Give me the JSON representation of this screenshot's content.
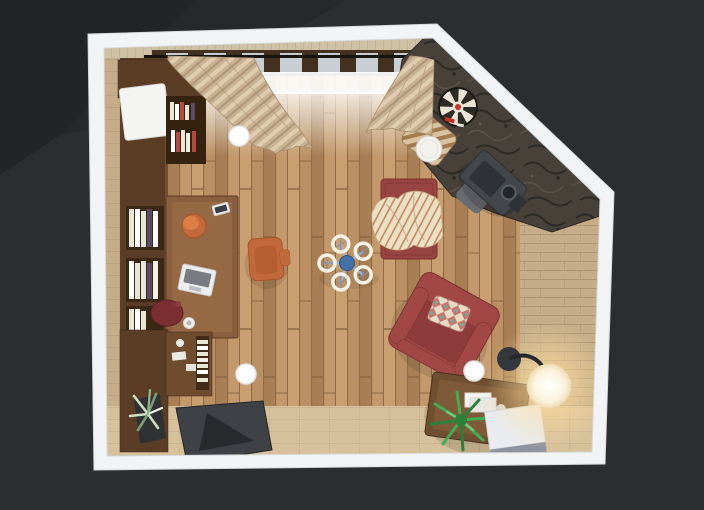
{
  "app": {
    "name": "3D Floor Plan — Top View Render",
    "view_label": "Top-down view of a living room with home-office corner"
  },
  "scene": {
    "room": {
      "label": "Living room floor plan, top view: pentagonal room with a cut corner, white walls, wood plank floor, stone accent wall along the diagonal",
      "wall_color_name": "white",
      "floor_material": "wood planks"
    },
    "objects": [
      {
        "id": "wall-cabinet",
        "label": "Dark wood wall cabinet with white door box",
        "zone": "top-left"
      },
      {
        "id": "wall-shelf-books",
        "label": "Open wall shelf with books",
        "zone": "top-left"
      },
      {
        "id": "bookshelf",
        "label": "Bookshelf with cream book spines",
        "zone": "left wall"
      },
      {
        "id": "office-desk",
        "label": "Dark wood office desk",
        "zone": "left"
      },
      {
        "id": "laptop",
        "label": "Laptop on desk",
        "zone": "left"
      },
      {
        "id": "tablet",
        "label": "Tablet on desk",
        "zone": "left"
      },
      {
        "id": "desk-cup",
        "label": "Orange desk organizer cup",
        "zone": "left"
      },
      {
        "id": "desk-lamp",
        "label": "Maroon table lamp with mug",
        "zone": "left"
      },
      {
        "id": "orange-armchair",
        "label": "Orange reading armchair",
        "zone": "center-left"
      },
      {
        "id": "ceiling-fan",
        "label": "5-blade ceiling fan with lights, blue hub",
        "zone": "center"
      },
      {
        "id": "ceiling-light",
        "label": "Round flush ceiling light (x3)",
        "zone": "various"
      },
      {
        "id": "window",
        "label": "Window band with dark mullions and curtain rod",
        "zone": "top wall"
      },
      {
        "id": "curtains",
        "label": "Beige wavy curtains, left and right",
        "zone": "top wall"
      },
      {
        "id": "stone-wall",
        "label": "Dark stone accent wall",
        "zone": "diagonal corner"
      },
      {
        "id": "dartboard",
        "label": "Dartboard on stone wall",
        "zone": "diagonal corner"
      },
      {
        "id": "wood-stove",
        "label": "Dark grey wood stove with pipe",
        "zone": "diagonal corner"
      },
      {
        "id": "floor-cushion",
        "label": "Grey floor cushion",
        "zone": "near stove"
      },
      {
        "id": "lounge-chair",
        "label": "Striped lounge chair",
        "zone": "upper right"
      },
      {
        "id": "round-side-table",
        "label": "White round side table",
        "zone": "upper right"
      },
      {
        "id": "red-daybed",
        "label": "Brick-red daybed sofa",
        "zone": "center-right"
      },
      {
        "id": "throw-blanket",
        "label": "Striped cream throw blanket",
        "zone": "on daybed"
      },
      {
        "id": "red-armchair",
        "label": "Brick-red armchair, rotated",
        "zone": "lower right"
      },
      {
        "id": "pillow",
        "label": "Patterned throw pillow",
        "zone": "on armchair"
      },
      {
        "id": "coffee-table",
        "label": "Dark wood coffee table with white books",
        "zone": "bottom right"
      },
      {
        "id": "palm-plant",
        "label": "Green palm plant",
        "zone": "bottom right"
      },
      {
        "id": "cube-table",
        "label": "White and grey cube side table",
        "zone": "bottom right"
      },
      {
        "id": "arc-floor-lamp",
        "label": "Glowing globe floor lamp with dark base",
        "zone": "bottom right corner"
      },
      {
        "id": "dark-rug",
        "label": "Dark angular rug",
        "zone": "bottom center-left"
      },
      {
        "id": "sideboard",
        "label": "Dark wood sideboard with dishes and books",
        "zone": "bottom left"
      },
      {
        "id": "potted-plant",
        "label": "Pale potted plant",
        "zone": "bottom left"
      }
    ]
  },
  "colors": {
    "bg": "#2b2d2f",
    "bg-dark": "#222426",
    "wall": "#f2f3f4",
    "wall-edge": "#d7d9db",
    "wall-face": "#cfc1a5",
    "floor-beige": "#c4ad88",
    "floor-beige-light": "#d7c19b",
    "plank": "#bb9164",
    "plank-light": "#c99f71",
    "plank-dark": "#a87f55",
    "plank-seam": "#8c6743",
    "wood-dark": "#5b3d26",
    "wood-mid": "#6f4c2e",
    "wood-light": "#8a6240",
    "desk": "#8a5f3d",
    "desk-light": "#9d7049",
    "stone": "#474139",
    "stone-dark": "#2e2a25",
    "stone-light": "#625a4d",
    "glass": "#c9ced3",
    "mullion": "#43311f",
    "rod": "#17130e",
    "curtain": "#c9b294",
    "curtain-light": "#e0cdb0",
    "curtain-dark": "#a98e6e",
    "red-sofa": "#974442",
    "red-chair": "#a14846",
    "red-dark": "#7c302f",
    "maroon": "#7c2f33",
    "throw": "#ecdfc4",
    "throw-stripe": "#c08a62",
    "pillow-base": "#e6dcc6",
    "pillow-red": "#c0625c",
    "pillow-teal": "#7ba896",
    "orange": "#c2693b",
    "orange-dark": "#a65427",
    "book-cream": "#e9e8d6",
    "book-accent": "#5b4a63",
    "book-red": "#b14a3f",
    "fan-blue": "#4472a8",
    "fan-arm": "#9fb3cf",
    "fan-ring": "#f6f2e6",
    "stove": "#43474c",
    "stove-dark": "#2f3237",
    "cube-top": "#e9ebef",
    "cube-side": "#8f939f",
    "lamp-sphere": "#fbf3df",
    "lamp-glow": "#ffdf9e",
    "plant-green": "#3fae54",
    "plant-green-dark": "#2d7f3c",
    "plant-pale": "#cfe0c2",
    "pot": "#2f3133",
    "mat": "#3e4145",
    "mat-dark": "#282a2d",
    "table-brown": "#6f4e31",
    "table-top": "#7f5a38",
    "light-circle": "#fdfdfd"
  }
}
